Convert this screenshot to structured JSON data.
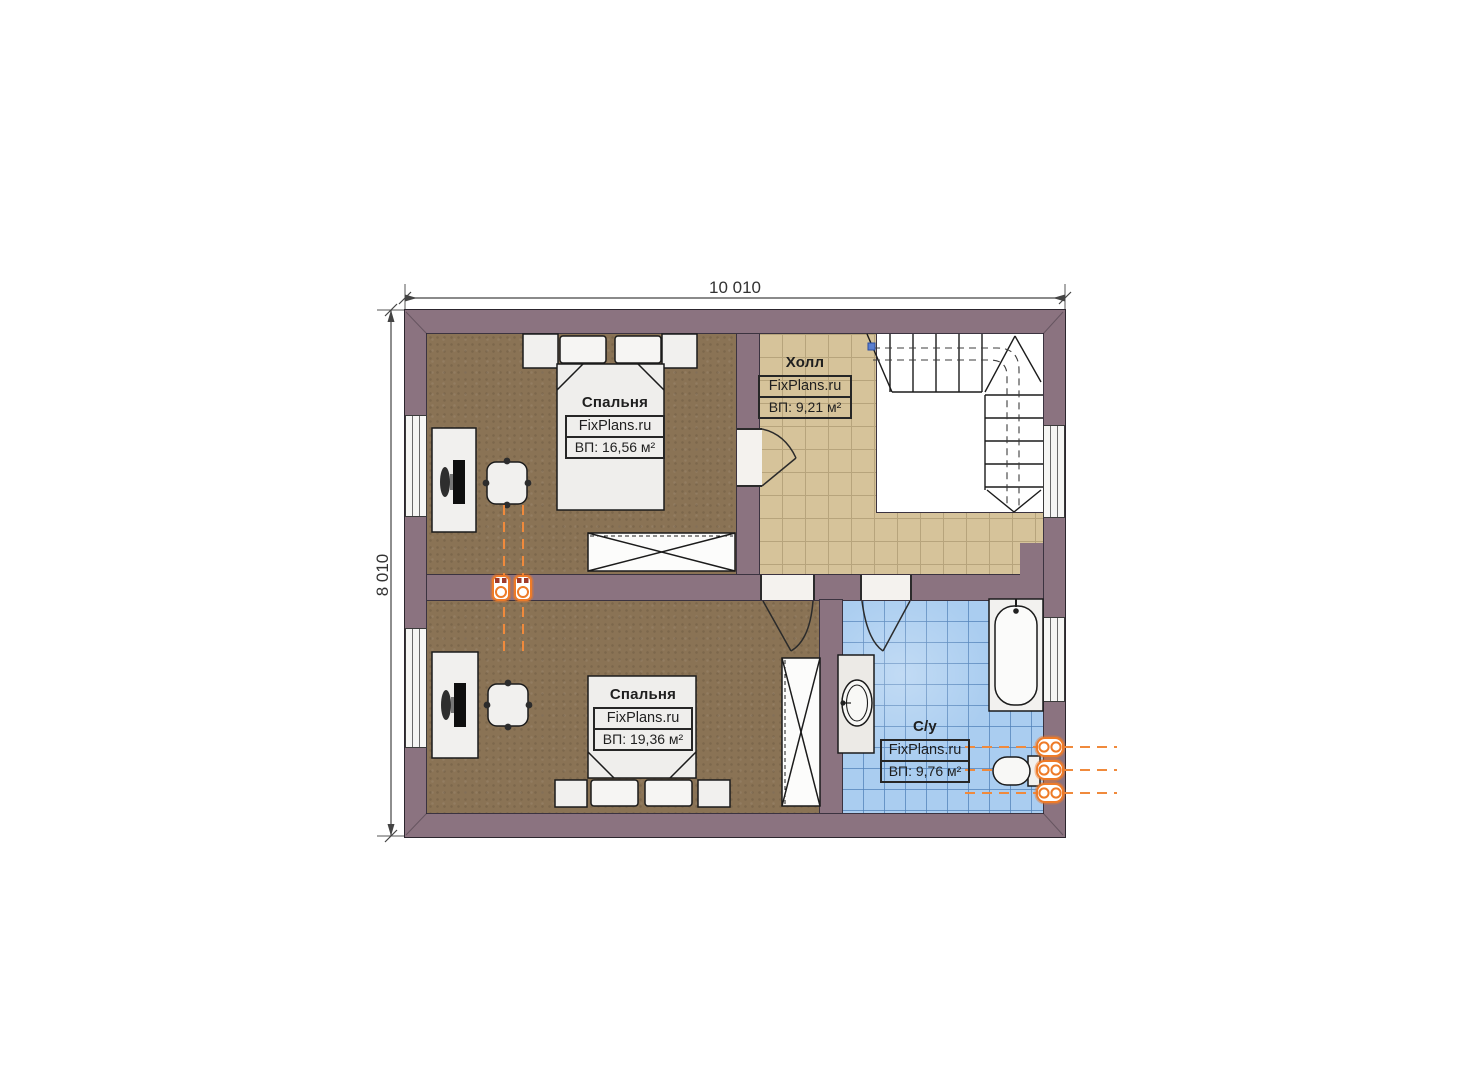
{
  "dimensions": {
    "width_label": "10 010",
    "height_label": "8 010"
  },
  "rooms": {
    "bedroom1": {
      "name": "Спальня",
      "brand": "FixPlans.ru",
      "area": "ВП: 16,56 м²"
    },
    "hall": {
      "name": "Холл",
      "brand": "FixPlans.ru",
      "area": "ВП: 9,21 м²"
    },
    "bedroom2": {
      "name": "Спальня",
      "brand": "FixPlans.ru",
      "area": "ВП: 19,36 м²"
    },
    "bathroom": {
      "name": "С/у",
      "brand": "FixPlans.ru",
      "area": "ВП: 9,76 м²"
    }
  },
  "colors": {
    "wall": "#8b7380",
    "bedroom_floor": "#8a7355",
    "hall_tile": "#d6c39a",
    "bathroom_tile": "#aacdf0",
    "furniture": "#f1f0ee",
    "accent_orange": "#ee7b28",
    "line": "#2b2b2b"
  }
}
